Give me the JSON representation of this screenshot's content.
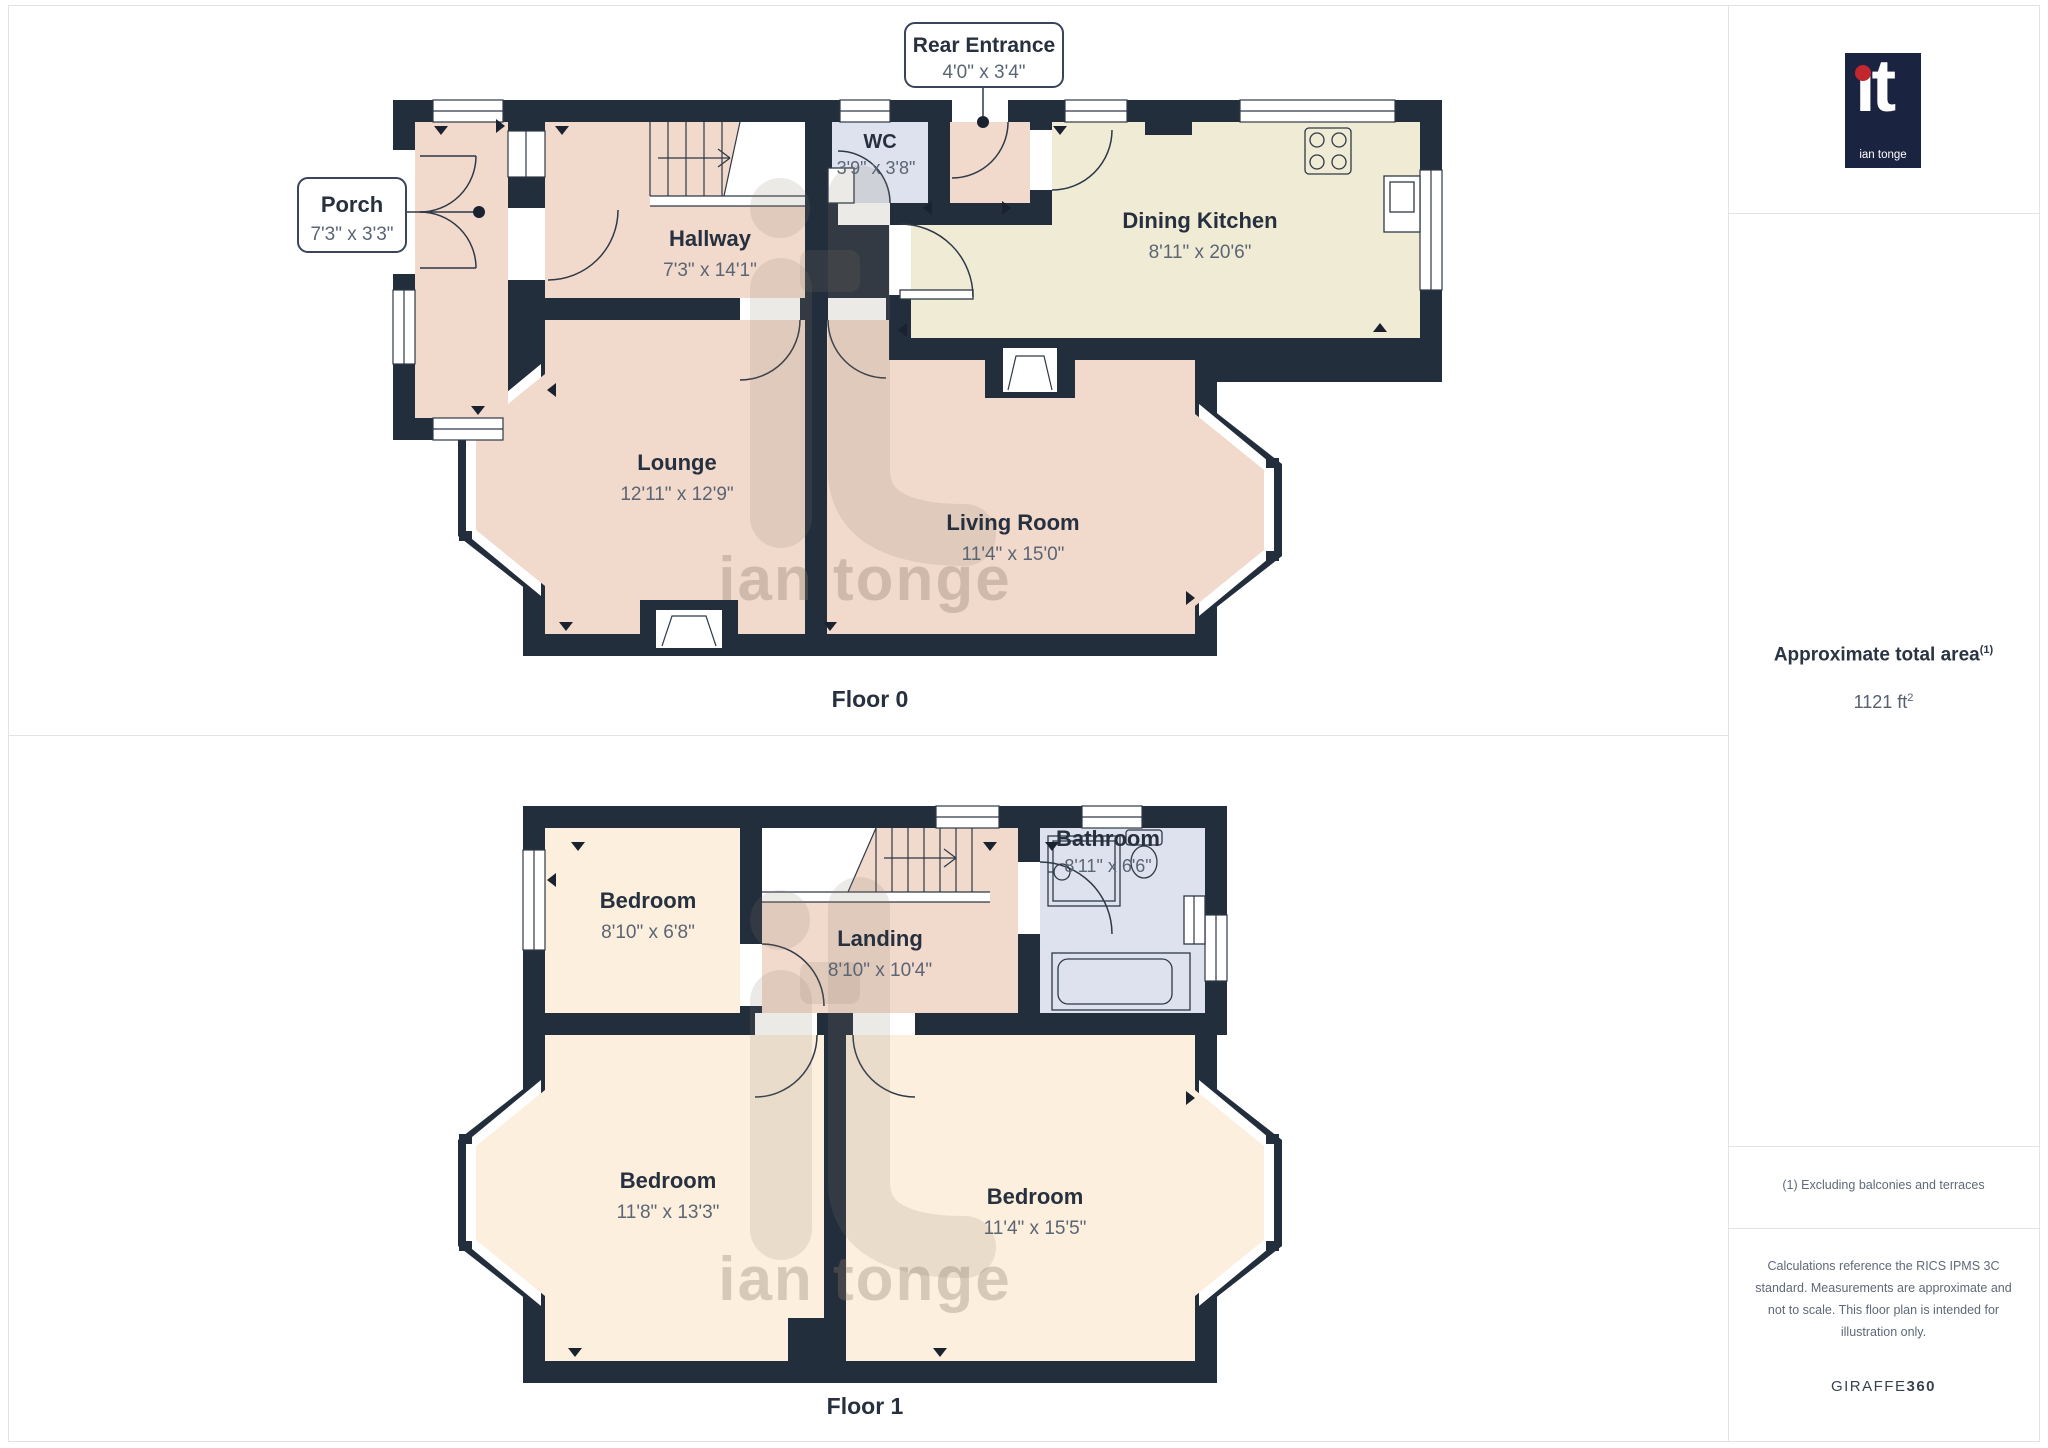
{
  "floor0": {
    "caption": "Floor 0",
    "rooms": {
      "porch": {
        "name": "Porch",
        "dims": "7'3\" x 3'3\""
      },
      "hallway": {
        "name": "Hallway",
        "dims": "7'3\" x 14'1\""
      },
      "wc": {
        "name": "WC",
        "dims": "3'9\" x 3'8\""
      },
      "rear_entrance": {
        "name": "Rear Entrance",
        "dims": "4'0\" x 3'4\""
      },
      "dining_kitchen": {
        "name": "Dining Kitchen",
        "dims": "8'11\" x 20'6\""
      },
      "lounge": {
        "name": "Lounge",
        "dims": "12'11\" x 12'9\""
      },
      "living_room": {
        "name": "Living Room",
        "dims": "11'4\" x 15'0\""
      }
    }
  },
  "floor1": {
    "caption": "Floor 1",
    "rooms": {
      "bedroom_small": {
        "name": "Bedroom",
        "dims": "8'10\" x 6'8\""
      },
      "landing": {
        "name": "Landing",
        "dims": "8'10\" x 10'4\""
      },
      "bathroom": {
        "name": "Bathroom",
        "dims": "8'11\" x 6'6\""
      },
      "bedroom_left": {
        "name": "Bedroom",
        "dims": "11'8\" x 13'3\""
      },
      "bedroom_right": {
        "name": "Bedroom",
        "dims": "11'4\" x 15'5\""
      }
    }
  },
  "watermark": {
    "text": "ian tonge"
  },
  "sidebar": {
    "logo": {
      "text": "ıt",
      "subtext": "ian tonge"
    },
    "area": {
      "label": "Approximate total area",
      "label_sup": "(1)",
      "value": "1121 ft",
      "value_sup": "2"
    },
    "note": "(1) Excluding balconies and terraces",
    "disclaimer": "Calculations reference the RICS IPMS 3C standard. Measurements are approximate and not to scale. This floor plan is intended for illustration only.",
    "brand": {
      "name": "GIRAFFE",
      "suffix": "360"
    }
  },
  "colors": {
    "wall": "#232e3c",
    "room_pink": "#f1d9cb",
    "room_cream": "#f0ebd5",
    "room_cream_light": "#fcefdd",
    "room_blue": "#dde2ee",
    "label": "#27303f",
    "dims": "#5b6574",
    "logo_bg": "#1a2440",
    "logo_dot": "#c1272d"
  }
}
